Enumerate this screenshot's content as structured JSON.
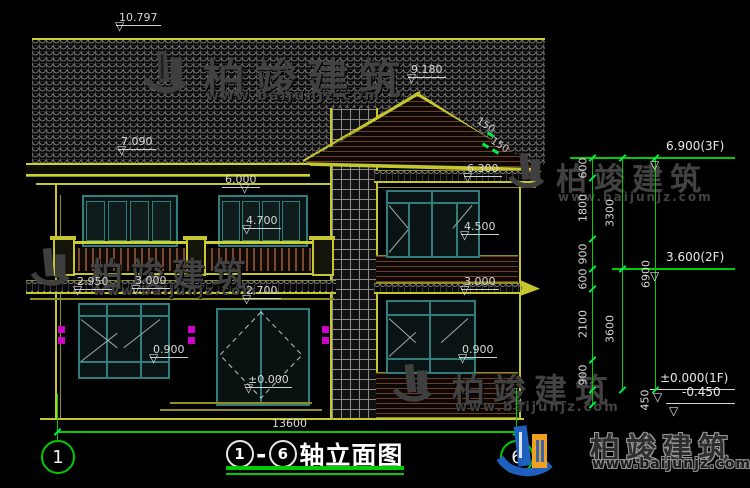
{
  "drawing": {
    "title": {
      "axis_left": "1",
      "dash": "-",
      "axis_right": "6",
      "name": "轴立面图"
    },
    "axis_bubbles": {
      "left": "1",
      "right": "6"
    },
    "bottom_dim": "13600",
    "level_markers": [
      "10.797",
      "7.090",
      "9.180",
      "6.000",
      "4.700",
      "6.300",
      "4.500",
      "2.950",
      "3.000",
      "2.700",
      "3.000",
      "0.900",
      "0.900",
      "±0.000"
    ],
    "right_levels": [
      "6.900(3F)",
      "3.600(2F)",
      "±0.000(1F)",
      "-0.450"
    ],
    "chain_segments": [
      "600",
      "1800",
      "900",
      "600",
      "2100",
      "900",
      "450"
    ],
    "chain_totals": [
      "3300",
      "3600"
    ],
    "chain_overall": "6900",
    "slope_label": "150"
  },
  "watermark": {
    "name": "柏竣建筑",
    "url": "www.baijunjz.com"
  },
  "colors": {
    "line_yellow": "#c6c62e",
    "dim_green": "#00cc00",
    "text_gray": "#d8d8d8",
    "magenta": "#cc00cc",
    "window_teal": "#2f7d7d",
    "logo_blue": "#1f5fbf",
    "logo_orange": "#f0a01e"
  }
}
